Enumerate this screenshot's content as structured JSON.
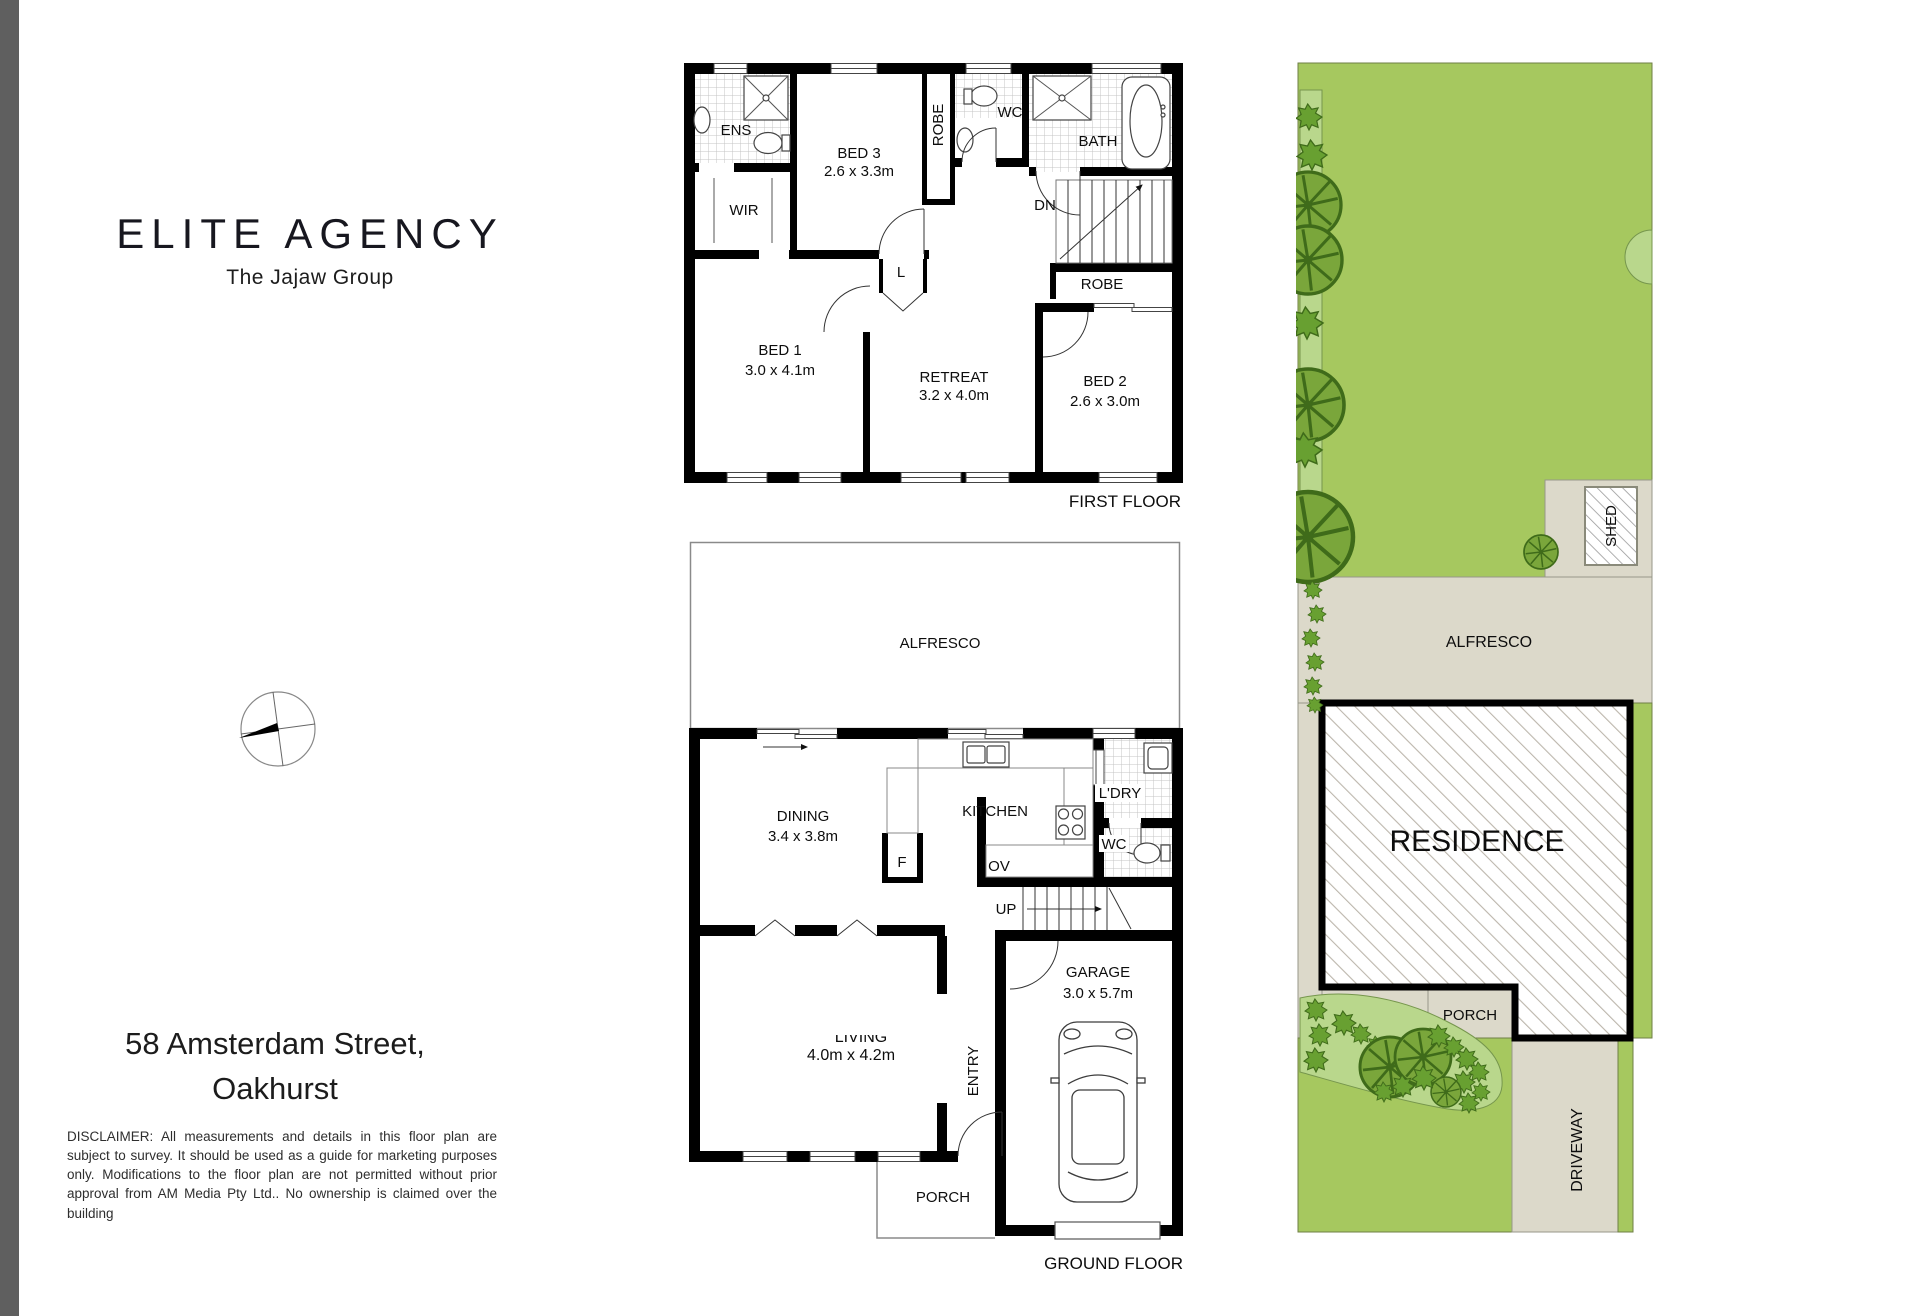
{
  "branding": {
    "logo": "ELITE AGENCY",
    "tagline": "The Jajaw Group"
  },
  "address": {
    "line1": "58 Amsterdam Street,",
    "line2": "Oakhurst"
  },
  "disclaimer": "DISCLAIMER: All measurements and details in this floor plan are subject to survey. It should be used as a guide for marketing purposes only. Modifications to the floor plan are not permitted without prior approval from AM Media Pty Ltd.. No ownership is claimed over the building",
  "first_floor": {
    "label": "FIRST FLOOR",
    "rooms": {
      "ens": "ENS",
      "wir": "WIR",
      "bed3_name": "BED 3",
      "bed3_dims": "2.6 x 3.3m",
      "robe_top": "ROBE",
      "wc": "WC",
      "bath": "BATH",
      "dn": "DN",
      "linen": "L",
      "robe_right": "ROBE",
      "bed1_name": "BED 1",
      "bed1_dims": "3.0 x 4.1m",
      "retreat_name": "RETREAT",
      "retreat_dims": "3.2 x 4.0m",
      "bed2_name": "BED 2",
      "bed2_dims": "2.6 x 3.0m"
    }
  },
  "ground_floor": {
    "label": "GROUND FLOOR",
    "rooms": {
      "alfresco": "ALFRESCO",
      "dining_name": "DINING",
      "dining_dims": "3.4 x 3.8m",
      "fridge": "F",
      "kitchen": "KITCHEN",
      "oven": "OV",
      "laundry": "L'DRY",
      "wc": "WC",
      "up": "UP",
      "living_name": "LIVING",
      "living_dims": "4.0m x 4.2m",
      "entry": "ENTRY",
      "garage_name": "GARAGE",
      "garage_dims": "3.0 x 5.7m",
      "porch": "PORCH"
    }
  },
  "site_plan": {
    "shed": "SHED",
    "alfresco": "ALFRESCO",
    "residence": "RESIDENCE",
    "porch": "PORCH",
    "driveway": "DRIVEWAY"
  },
  "colors": {
    "lawn": "#a6c85f",
    "garden_bed": "#b9d78c",
    "tree": "#7aa63b",
    "tree_dark": "#68a031",
    "tree_line": "#3f6b1a",
    "paving": "#dcd9ca",
    "wall": "#000000",
    "sidebar_gray": "#5f5f5f",
    "ink": "#111111"
  }
}
